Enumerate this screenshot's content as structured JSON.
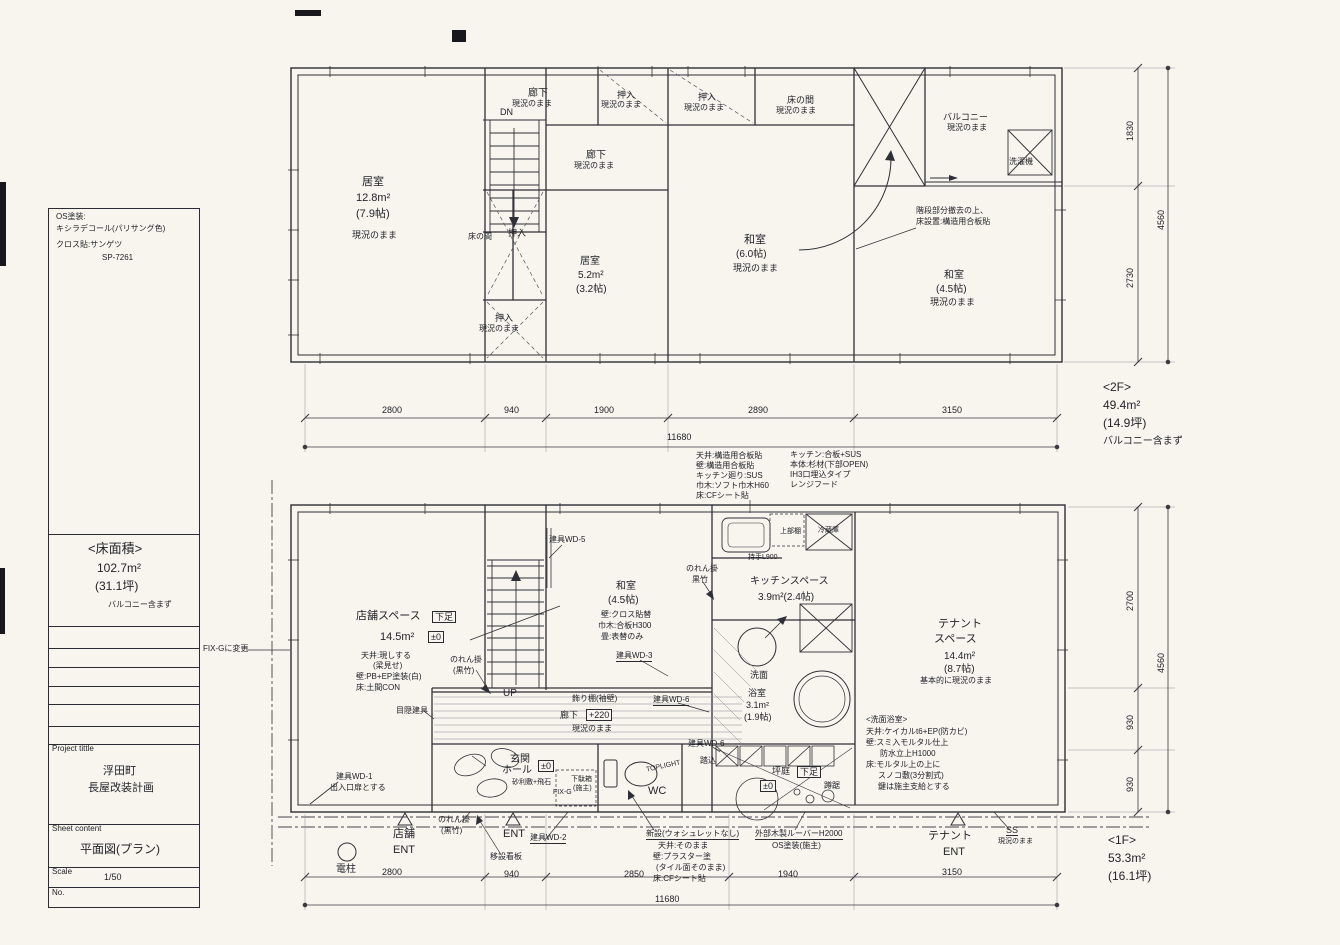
{
  "title_block": {
    "paint1": "OS塗装:",
    "paint2": "キシラデコール(パリサング色)",
    "cloth1": "クロス貼:サンゲツ",
    "cloth2": "SP-7261",
    "area_title": "<床面積>",
    "area": "102.7m²",
    "tsubo": "(31.1坪)",
    "note": "バルコニー含まず",
    "project_label": "Project tittle",
    "project1": "浮田町",
    "project2": "長屋改装計画",
    "sheet_label": "Sheet content",
    "sheet": "平面図(プラン)",
    "scale_label": "Scale",
    "scale": "1/50",
    "no_label": "No."
  },
  "common": {
    "asis": "現況のまま",
    "dn": "DN",
    "up": "UP",
    "ent": "ENT"
  },
  "floor2": {
    "corridor_top": "廊下",
    "closet_top": "押入",
    "room1": "居室",
    "room1_area": "12.8m²",
    "room1_tatami": "(7.9帖)",
    "corridor_mid": "廊下",
    "tokonoma_left": "床の間",
    "closet_mid": "押入",
    "room2": "居室",
    "room2_area": "5.2m²",
    "room2_tatami": "(3.2帖)",
    "closet_bottom": "押入",
    "closet_right": "押入",
    "tokonoma_right": "床の間",
    "washitsu6": "和室",
    "washitsu6_tatami": "(6.0帖)",
    "washitsu45": "和室",
    "washitsu45_tatami": "(4.5帖)",
    "balcony": "バルコニー",
    "washer": "洗濯機",
    "stair_note1": "階段部分撤去の上、",
    "stair_note2": "床設置:構造用合板貼",
    "floor_label": "<2F>",
    "floor_area": "49.4m²",
    "floor_tsubo": "(14.9坪)",
    "floor_note": "バルコニー含まず",
    "dim1": "2800",
    "dim2": "940",
    "dim3": "1900",
    "dim4": "2890",
    "dim5": "3150",
    "dim_total": "11680",
    "rdim1": "1830",
    "rdim2": "2730",
    "rdim_total": "4560"
  },
  "kitchen_spec": {
    "c1l1": "天井:構造用合板貼",
    "c1l2": "壁:構造用合板貼",
    "c1l3": "キッチン廻り:SUS",
    "c1l4": "巾木:ソフト巾木H60",
    "c1l5": "床:CFシート貼",
    "c2l1": "キッチン:合板+SUS",
    "c2l2": "本体:杉材(下部OPEN)",
    "c2l3": "IH3口埋込タイプ",
    "c2l4": "レンジフード"
  },
  "floor1": {
    "fix_change": "FIX-Gに変更",
    "shop": "店舗スペース",
    "shop_tag": "下足",
    "shop_area": "14.5m²",
    "shop_level": "±0",
    "shop_n1": "天井:現しする",
    "shop_n2": "(梁見せ)",
    "shop_n3": "壁:PB+EP塗装(白)",
    "shop_n4": "床:土間CON",
    "noren": "のれん掛",
    "noren_b": "(黒竹)",
    "noren_kitchen": "のれん掛",
    "noren_kitchen_b": "黒竹",
    "noren_genkan": "のれん掛",
    "noren_genkan_b": "(黒竹)",
    "noren_out": "のれん掛",
    "noren_out_b": "(黒竹)",
    "wd5": "建具WD-5",
    "wd3": "建具WD-3",
    "wd6a": "建具WD-6",
    "wd6b": "建具WD-6",
    "wd2": "建具WD-2",
    "wd1": "建具WD-1",
    "wd1_note": "出入口扉とする",
    "mekakushi": "目隠建具",
    "washitsu": "和室",
    "washitsu_tatami": "(4.5帖)",
    "washitsu_n1": "壁:クロス貼替",
    "washitsu_n2": "巾木:合板H300",
    "washitsu_n3": "畳:表替のみ",
    "kazaridana": "飾り棚(袖壁)",
    "corridor": "廊下",
    "corridor_level": "+220",
    "kitchen": "キッチンスペース",
    "kitchen_area": "3.9m²(2.4帖)",
    "upper_shelf": "上部棚",
    "handle": "持手L900",
    "fridge": "冷蔵庫",
    "senmen": "洗面",
    "bath": "浴室",
    "bath_area": "3.1m²",
    "bath_tatami": "(1.9帖)",
    "bath_spec_title": "<洗面浴室>",
    "bath_n1": "天井:ケイカルt6+EP(防カビ)",
    "bath_n2": "壁:スミ入モルタル仕上",
    "bath_n3": "防水立上H1000",
    "bath_n4": "床:モルタル上の上に",
    "bath_n5": "スノコ敷(3分割式)",
    "bath_n6": "鍵は施主支給とする",
    "tenant1": "テナント",
    "tenant2": "スペース",
    "tenant_area": "14.4m²",
    "tenant_tatami": "(8.7帖)",
    "tenant_note": "基本的に現況のまま",
    "genkan1": "玄関",
    "genkan2": "ホール",
    "genkan_level": "±0",
    "genkan_note": "砂利敷+飛石",
    "getabako1": "下駄箱",
    "getabako2": "(施主)",
    "fixg": "FIX-G",
    "wc": "WC",
    "toplight": "TOPLIGHT",
    "fumikomi": "踏込",
    "wc_new": "新設(ウォシュレットなし)",
    "wc_n1": "天井:そのまま",
    "wc_n2": "壁:プラスター塗",
    "wc_n3": "(タイル面そのまま)",
    "wc_n4": "床:CFシート貼",
    "louver1": "外部木製ルーバーH2000",
    "louver2": "OS塗装(施主)",
    "tsubo": "坪庭",
    "tsubo_tag": "下足",
    "tsubo_level": "±0",
    "tsukubai": "蹲踞",
    "shop_ent": "店舗",
    "tenant_ent": "テナント",
    "ss": "SS",
    "denchu": "電柱",
    "kanban": "移設看板",
    "floor_label": "<1F>",
    "floor_area": "53.3m²",
    "floor_tsubo": "(16.1坪)",
    "dim1": "2800",
    "dim2": "940",
    "dim3": "2850",
    "dim4": "1940",
    "dim5": "3150",
    "dim_total": "11680",
    "rdim1": "2700",
    "rdim2": "930",
    "rdim3": "930",
    "rdim_total": "4560"
  }
}
